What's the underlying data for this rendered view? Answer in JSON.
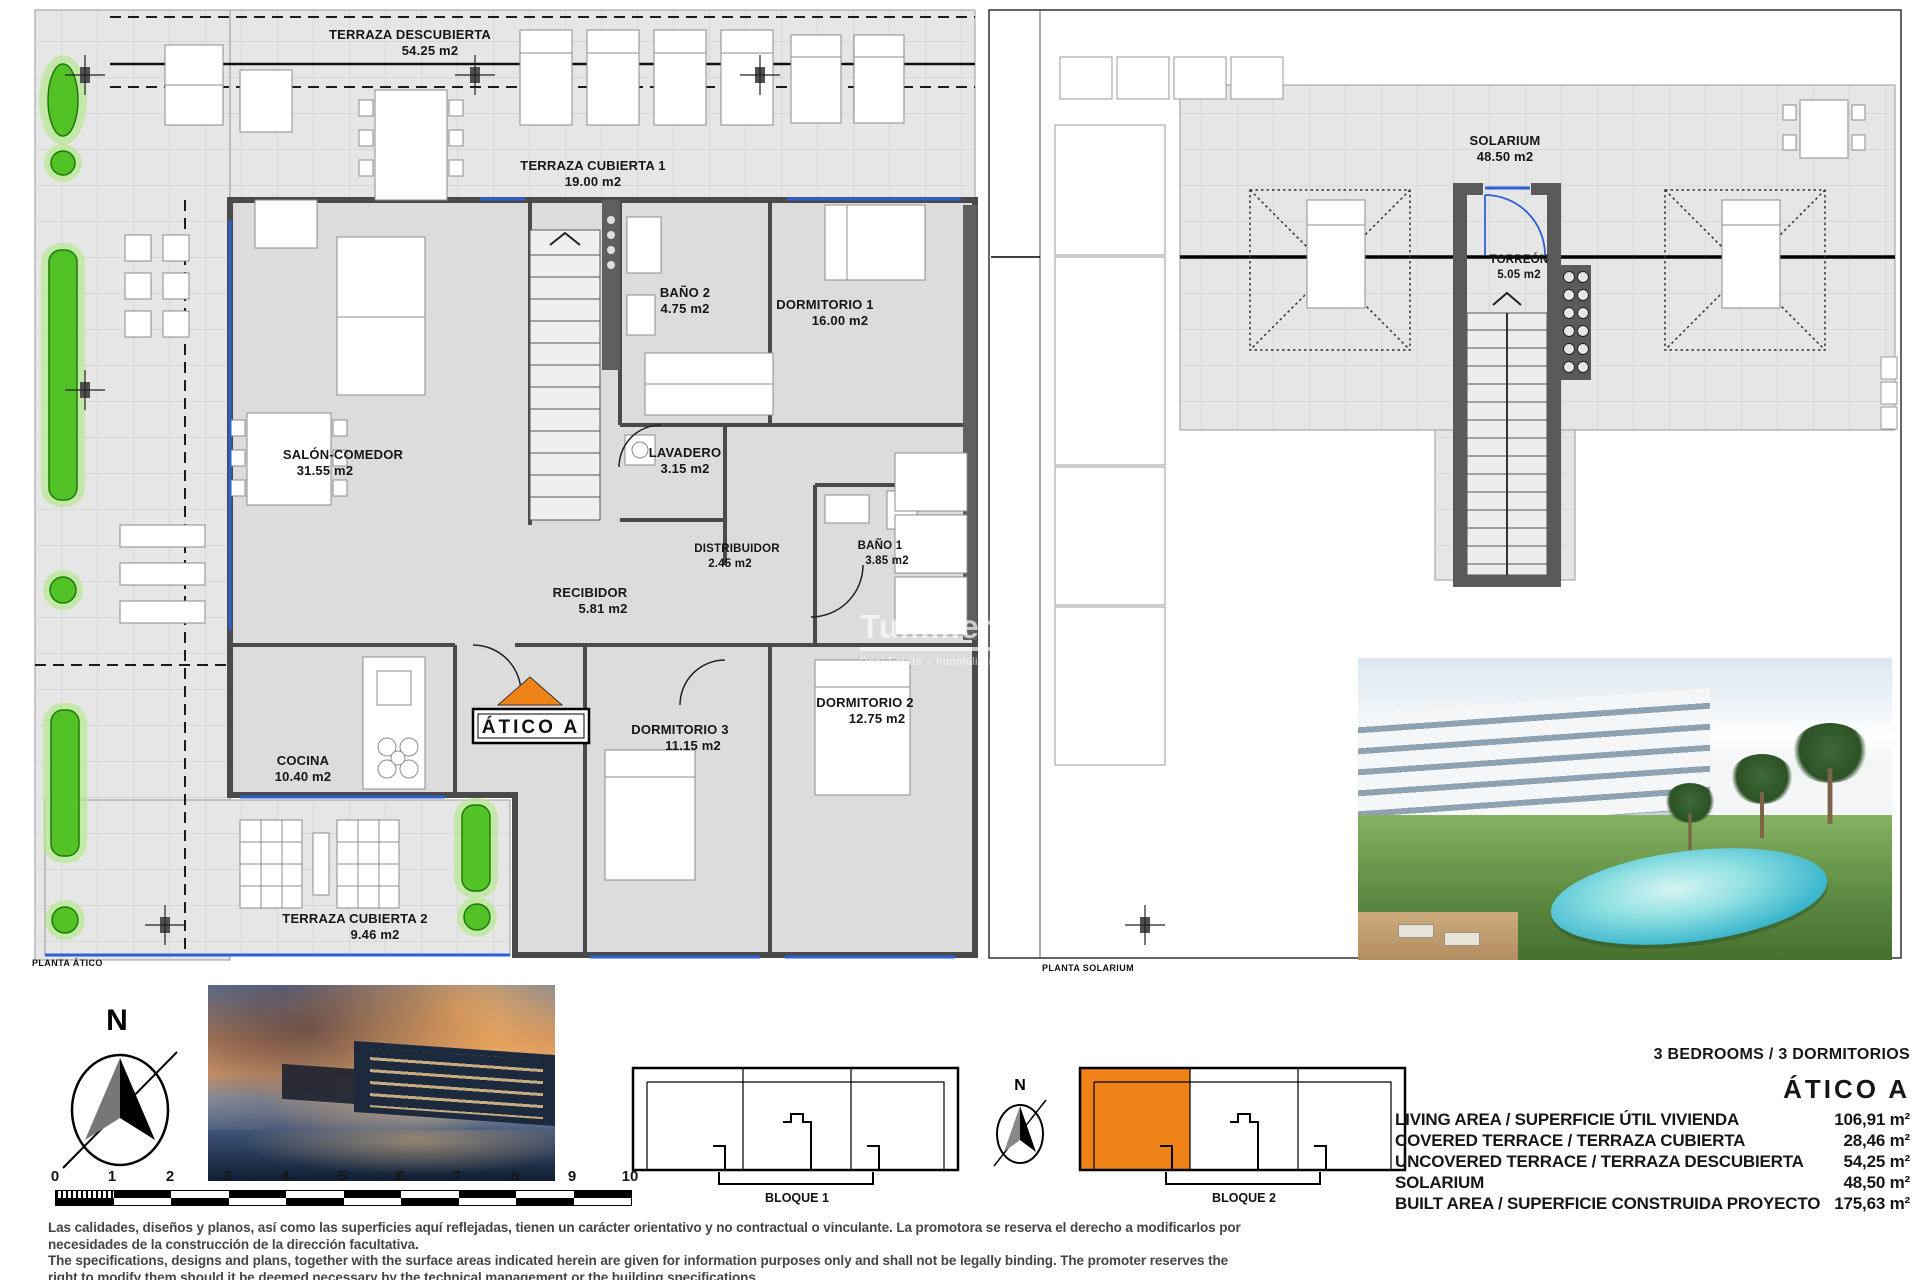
{
  "left_plan": {
    "caption": "PLANTA ÁTICO",
    "badge": "ÁTICO A",
    "rooms": {
      "terraza_descubierta": {
        "name": "TERRAZA DESCUBIERTA",
        "area": "54.25 m2"
      },
      "terraza_cubierta_1": {
        "name": "TERRAZA CUBIERTA 1",
        "area": "19.00 m2"
      },
      "salon_comedor": {
        "name": "SALÓN-COMEDOR",
        "area": "31.55 m2"
      },
      "bano_2": {
        "name": "BAÑO 2",
        "area": "4.75 m2"
      },
      "dormitorio_1": {
        "name": "DORMITORIO 1",
        "area": "16.00 m2"
      },
      "lavadero": {
        "name": "LAVADERO",
        "area": "3.15 m2"
      },
      "distribuidor": {
        "name": "DISTRIBUIDOR",
        "area": "2.45 m2"
      },
      "bano_1": {
        "name": "BAÑO 1",
        "area": "3.85 m2"
      },
      "recibidor": {
        "name": "RECIBIDOR",
        "area": "5.81 m2"
      },
      "dormitorio_3": {
        "name": "DORMITORIO 3",
        "area": "11.15 m2"
      },
      "dormitorio_2": {
        "name": "DORMITORIO 2",
        "area": "12.75 m2"
      },
      "cocina": {
        "name": "COCINA",
        "area": "10.40 m2"
      },
      "terraza_cubierta_2": {
        "name": "TERRAZA CUBIERTA 2",
        "area": "9.46 m2"
      }
    }
  },
  "right_plan": {
    "caption": "PLANTA SOLARIUM",
    "rooms": {
      "solarium": {
        "name": "SOLARIUM",
        "area": "48.50 m2"
      },
      "torreon": {
        "name": "TORREÓN",
        "area": "5.05 m2"
      }
    }
  },
  "watermark": {
    "brand": "Tummers",
    "tagline": "Real Estate – Inmobiliaria"
  },
  "compass": {
    "north": "N"
  },
  "scale_bar": {
    "ticks": [
      "0",
      "1",
      "2",
      "3",
      "4",
      "5",
      "6",
      "7",
      "8",
      "9",
      "10"
    ]
  },
  "blocks": {
    "block1": "BLOQUE 1",
    "block2": "BLOQUE 2"
  },
  "summary": {
    "bedrooms": "3 BEDROOMS / 3 DORMITORIOS",
    "unit": "ÁTICO  A",
    "rows": [
      {
        "label": "LIVING AREA / SUPERFICIE ÚTIL VIVIENDA",
        "value": "106,91 m²"
      },
      {
        "label": "COVERED TERRACE / TERRAZA CUBIERTA",
        "value": "28,46 m²"
      },
      {
        "label": "UNCOVERED TERRACE / TERRAZA DESCUBIERTA",
        "value": "54,25 m²"
      },
      {
        "label": "SOLARIUM",
        "value": "48,50 m²"
      },
      {
        "label": "BUILT AREA / SUPERFICIE CONSTRUIDA PROYECTO",
        "value": "175,63 m²"
      }
    ]
  },
  "disclaimer": {
    "es1": "Las calidades, diseños y planos, así como las superficies aquí reflejadas, tienen un carácter orientativo y no contractual o vinculante. La promotora se reserva el derecho a modificarlos por",
    "es2": "necesidades de la construcción de la dirección facultativa.",
    "en1": "The specifications, designs and plans, together with the surface areas indicated herein are given for information purposes only and shall not be legally binding. The promoter reserves the",
    "en2": "right to modify them should it be deemed necessary by the technical management or the building specifications."
  },
  "colors": {
    "accent_orange": "#f08318",
    "window_blue": "#2f5fd6",
    "plant_green": "#53c226",
    "wall_gray": "#4a4a4a"
  }
}
